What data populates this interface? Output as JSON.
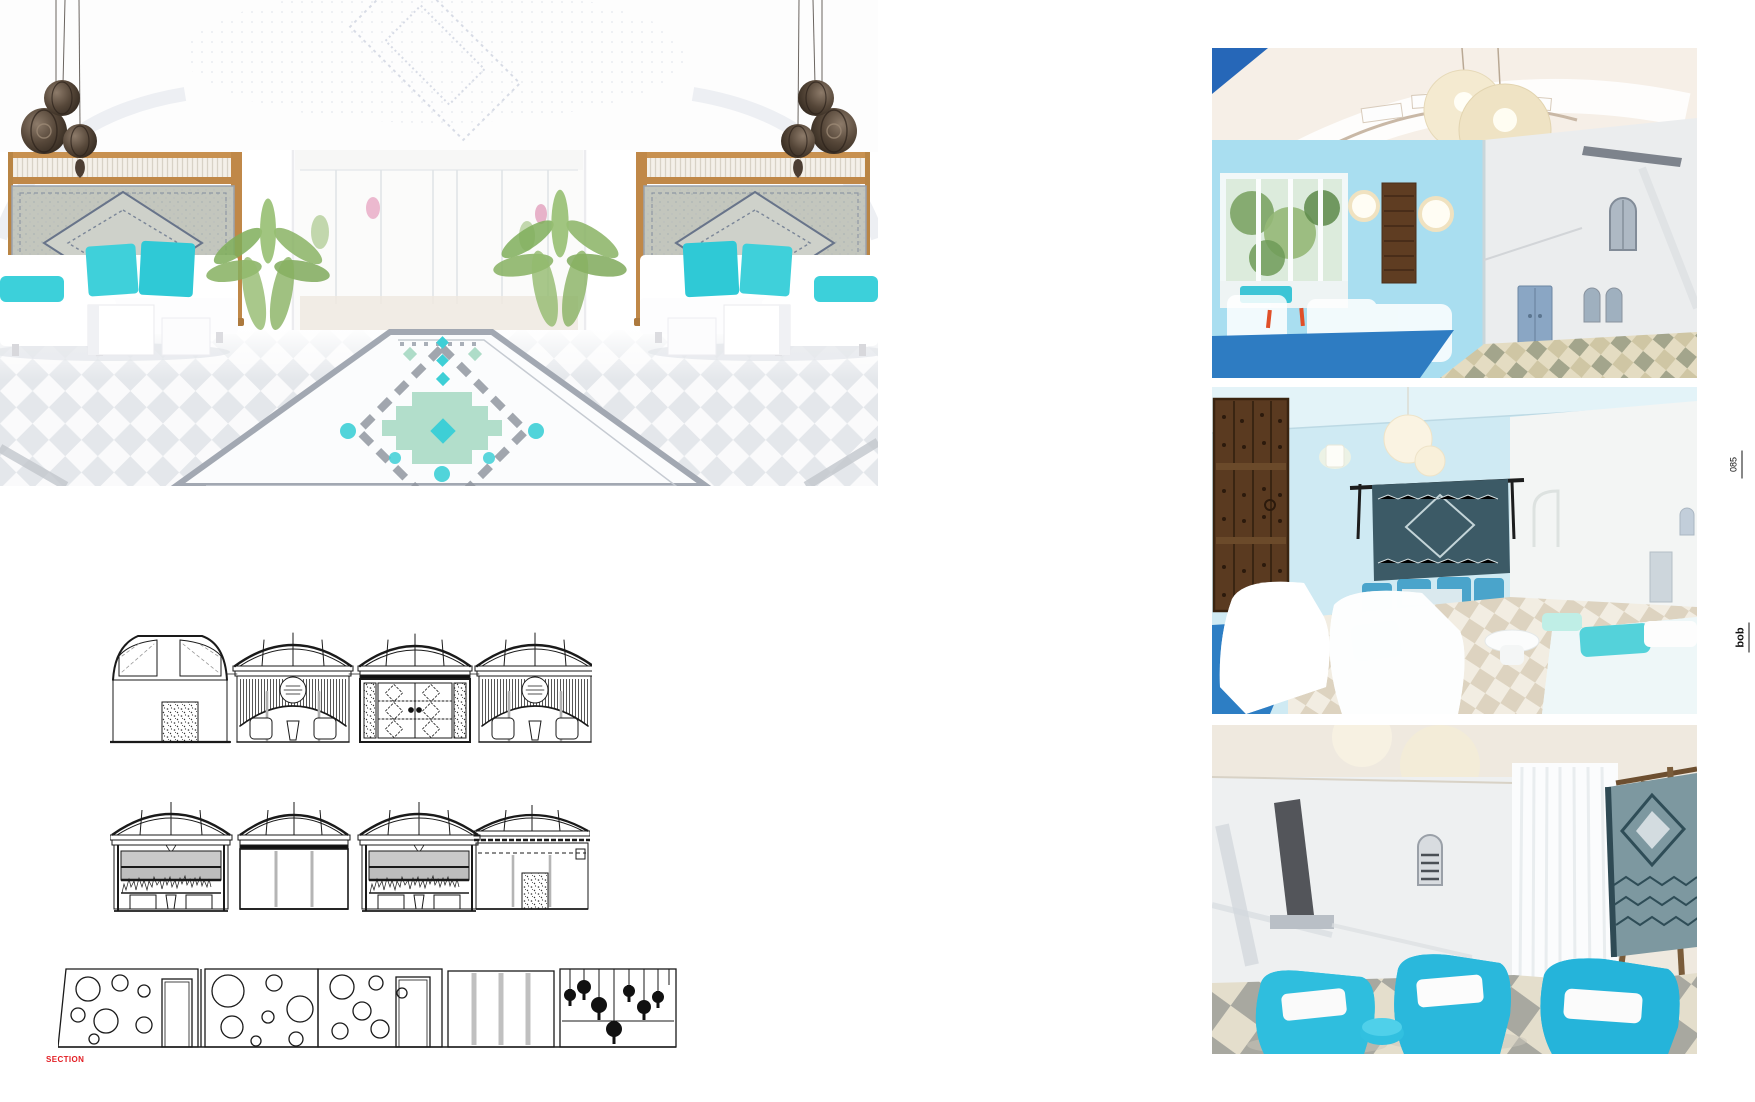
{
  "left_page": {
    "section_label": "SECTION"
  },
  "right_margin": {
    "page_number": "085",
    "logo": "bob"
  },
  "colors": {
    "accent_turquoise": "#3ecfd6",
    "mint_tile": "#aedcc8",
    "runner_gray": "#a2a8b2",
    "label_red": "#e31e24",
    "wood_frame": "#c08c4a",
    "lantern_brown": "#4c3e33",
    "photo_wall_blue": "#aee0ef",
    "carpet_blue": "#2e7cc2",
    "wire_chair_cyan": "#2cb9dc",
    "drawing_ink": "#1a1a1a"
  }
}
